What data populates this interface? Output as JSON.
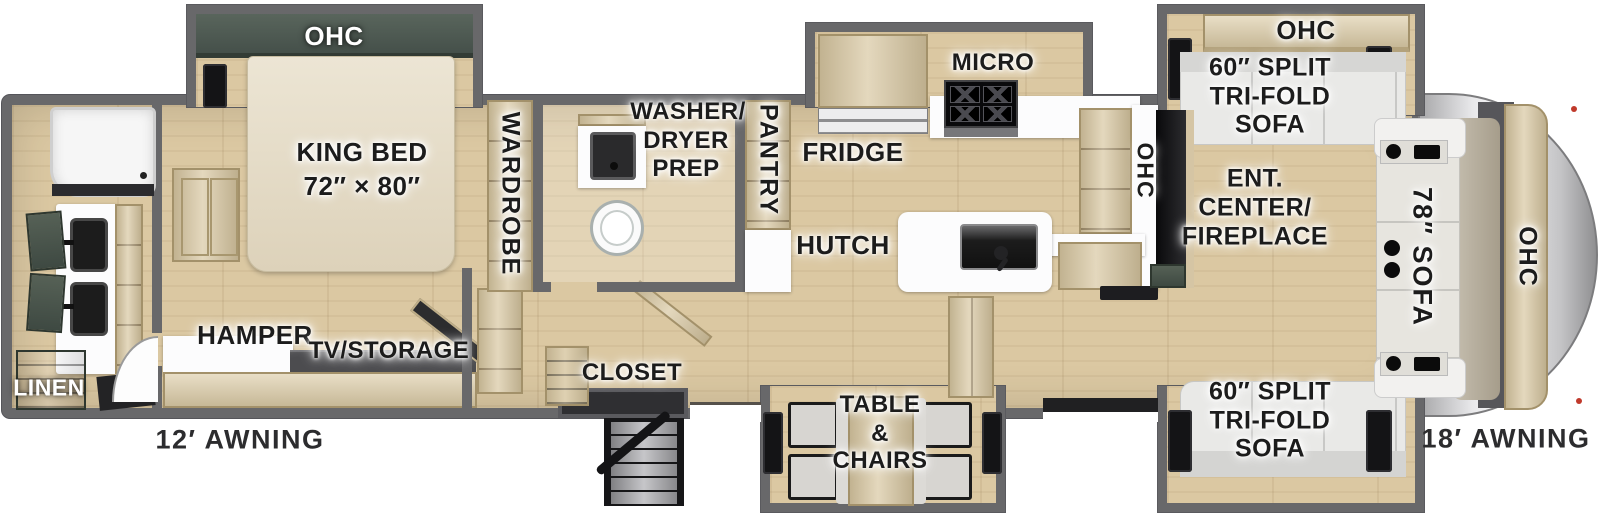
{
  "colors": {
    "wall": "#68686a",
    "floor": "#dbc8a2",
    "wood": "#d8c7a1",
    "cabinet_green": "#46514a",
    "ohc_green": "#4e5a52",
    "counter_white": "#fcfcfd",
    "cap_silver": "#d9d9d9",
    "label": "#1c1c1c"
  },
  "labels": {
    "bedroom_ohc": "OHC",
    "king_bed": [
      "KING BED",
      "72″ × 80″"
    ],
    "wardrobe": "WARDROBE",
    "washer_prep": [
      "WASHER/",
      "DRYER",
      "PREP"
    ],
    "pantry": "PANTRY",
    "micro": "MICRO",
    "fridge": "FRIDGE",
    "hutch": "HUTCH",
    "kitchen_ohc": "OHC",
    "hamper": "HAMPER",
    "tv_storage": "TV/STORAGE",
    "closet": "CLOSET",
    "linen": "LINEN",
    "table_chairs": [
      "TABLE",
      "&",
      "CHAIRS"
    ],
    "ent_center": [
      "ENT.",
      "CENTER/",
      "FIREPLACE"
    ],
    "sofa_top": [
      "60″ SPLIT",
      "TRI-FOLD",
      "SOFA"
    ],
    "sofa_bottom": [
      "60″ SPLIT",
      "TRI-FOLD",
      "SOFA"
    ],
    "front_sofa": "78″ SOFA",
    "living_ohc_top": "OHC",
    "front_ohc": "OHC",
    "awning_left": "12′ AWNING",
    "awning_right": "18′ AWNING"
  }
}
